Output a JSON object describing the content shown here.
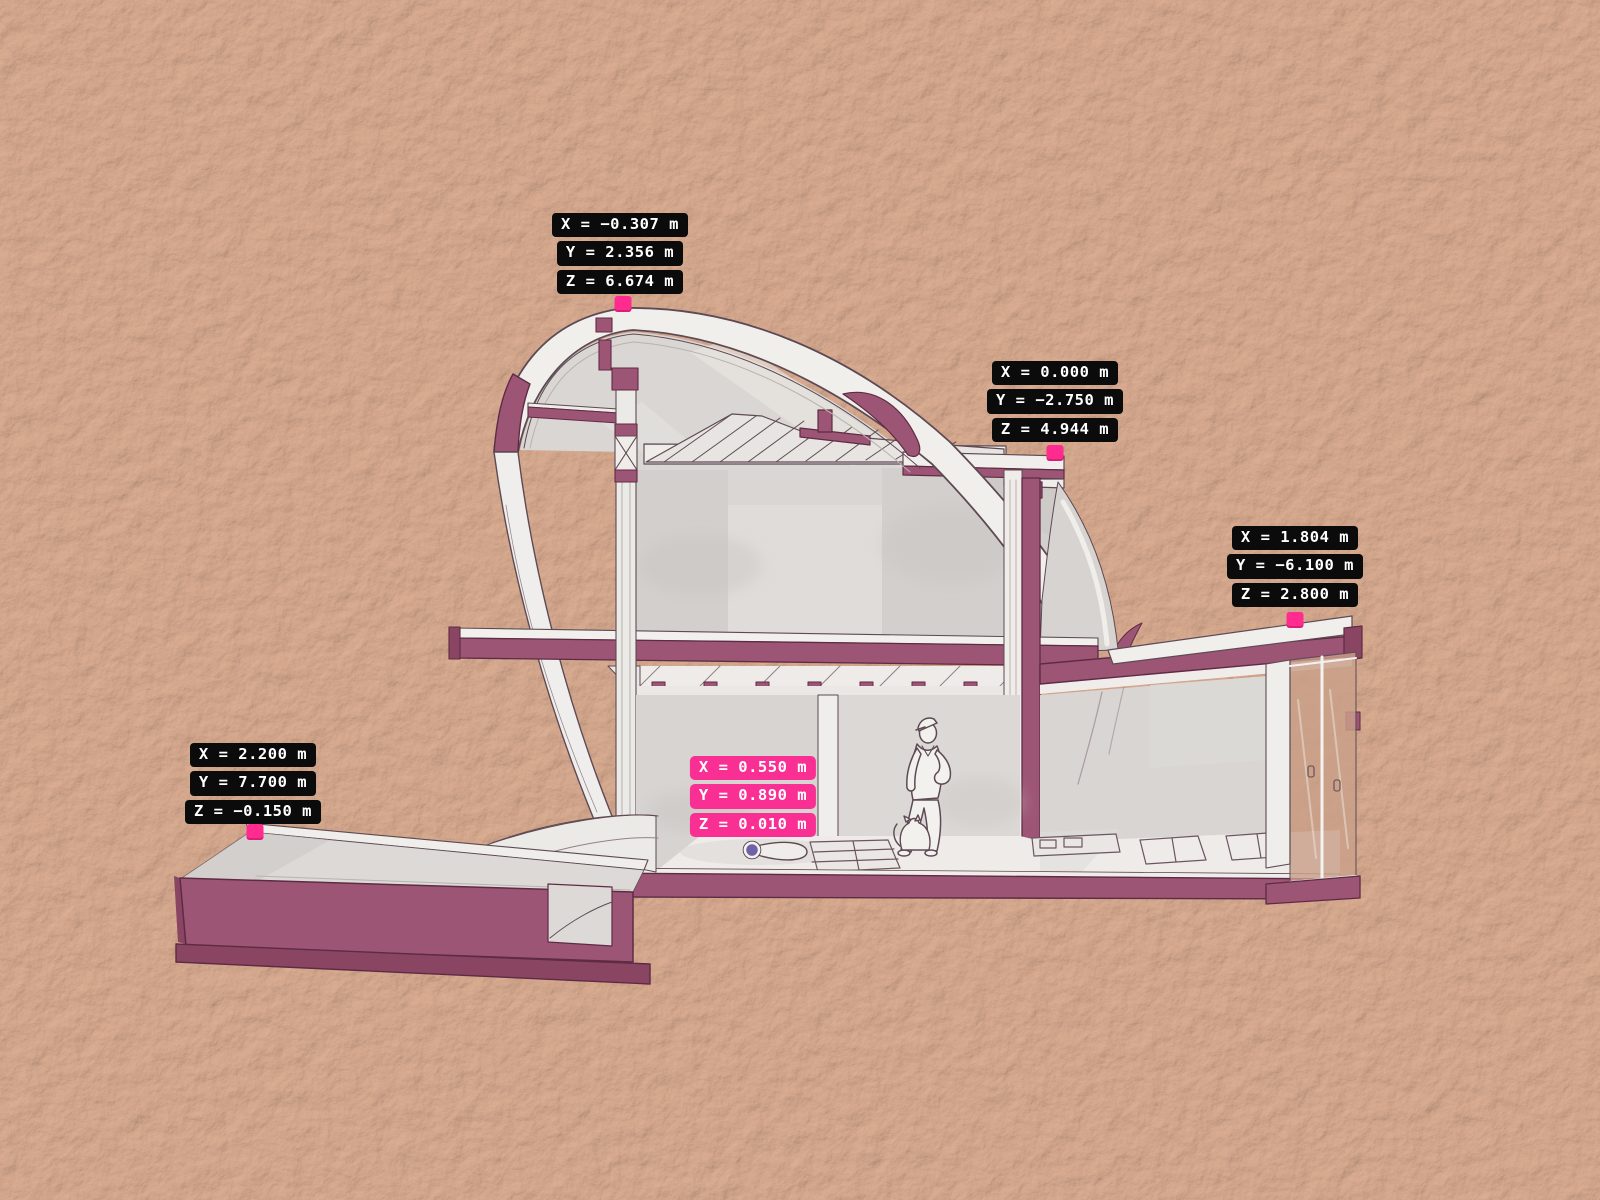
{
  "viewport": {
    "kind": "3d-section-viewport",
    "description": "Sectional perspective of a curved-shell house with pool terrace, person and cat, annotated with coordinate measurement labels",
    "background_color": "#c89e86",
    "width": 1600,
    "height": 1200
  },
  "colors": {
    "section_cut": "#9d5575",
    "section_cut_dark": "#8a4563",
    "outline": "#5d4a54",
    "surface_white": "#f1efec",
    "surface_gray": "#d8d5d2",
    "label_dark_bg": "#0b0b0b",
    "label_pink_bg": "#fa2f93",
    "label_text": "#ffffff",
    "marker_pink": "#ff2b8f",
    "point_dot": "#6f63a8"
  },
  "scene_entities": {
    "person": "standing figure with cap",
    "pet": "cat",
    "structures": [
      "curved shell roof",
      "two-story core",
      "single-story wing with sliding glass doors",
      "sunken pool basin"
    ]
  },
  "coordinate_labels": [
    {
      "id": "shell-apex",
      "theme": "dark",
      "cx": 620,
      "top": 213,
      "rows": [
        "X = −0.307 m",
        "Y = 2.356 m",
        "Z = 6.674 m"
      ],
      "marker": {
        "cx": 623,
        "cy": 304
      }
    },
    {
      "id": "upper-roof-edge",
      "theme": "dark",
      "cx": 1055,
      "top": 361,
      "rows": [
        "X = 0.000 m",
        "Y = −2.750 m",
        "Z = 4.944 m"
      ],
      "marker": {
        "cx": 1055,
        "cy": 453
      }
    },
    {
      "id": "wing-roof-corner",
      "theme": "dark",
      "cx": 1295,
      "top": 526,
      "rows": [
        "X = 1.804 m",
        "Y = −6.100 m",
        "Z = 2.800 m"
      ],
      "marker": {
        "cx": 1295,
        "cy": 620
      }
    },
    {
      "id": "pool-rim-corner",
      "theme": "dark",
      "cx": 253,
      "top": 743,
      "rows": [
        "X = 2.200 m",
        "Y = 7.700 m",
        "Z = −0.150 m"
      ],
      "marker": {
        "cx": 255,
        "cy": 832
      }
    },
    {
      "id": "selected-floor-point",
      "theme": "pink",
      "cx": 753,
      "top": 756,
      "rows": [
        "X = 0.550 m",
        "Y = 0.890 m",
        "Z = 0.010 m"
      ],
      "marker": null
    }
  ],
  "selected_point_dot": {
    "cx": 752,
    "cy": 850
  }
}
